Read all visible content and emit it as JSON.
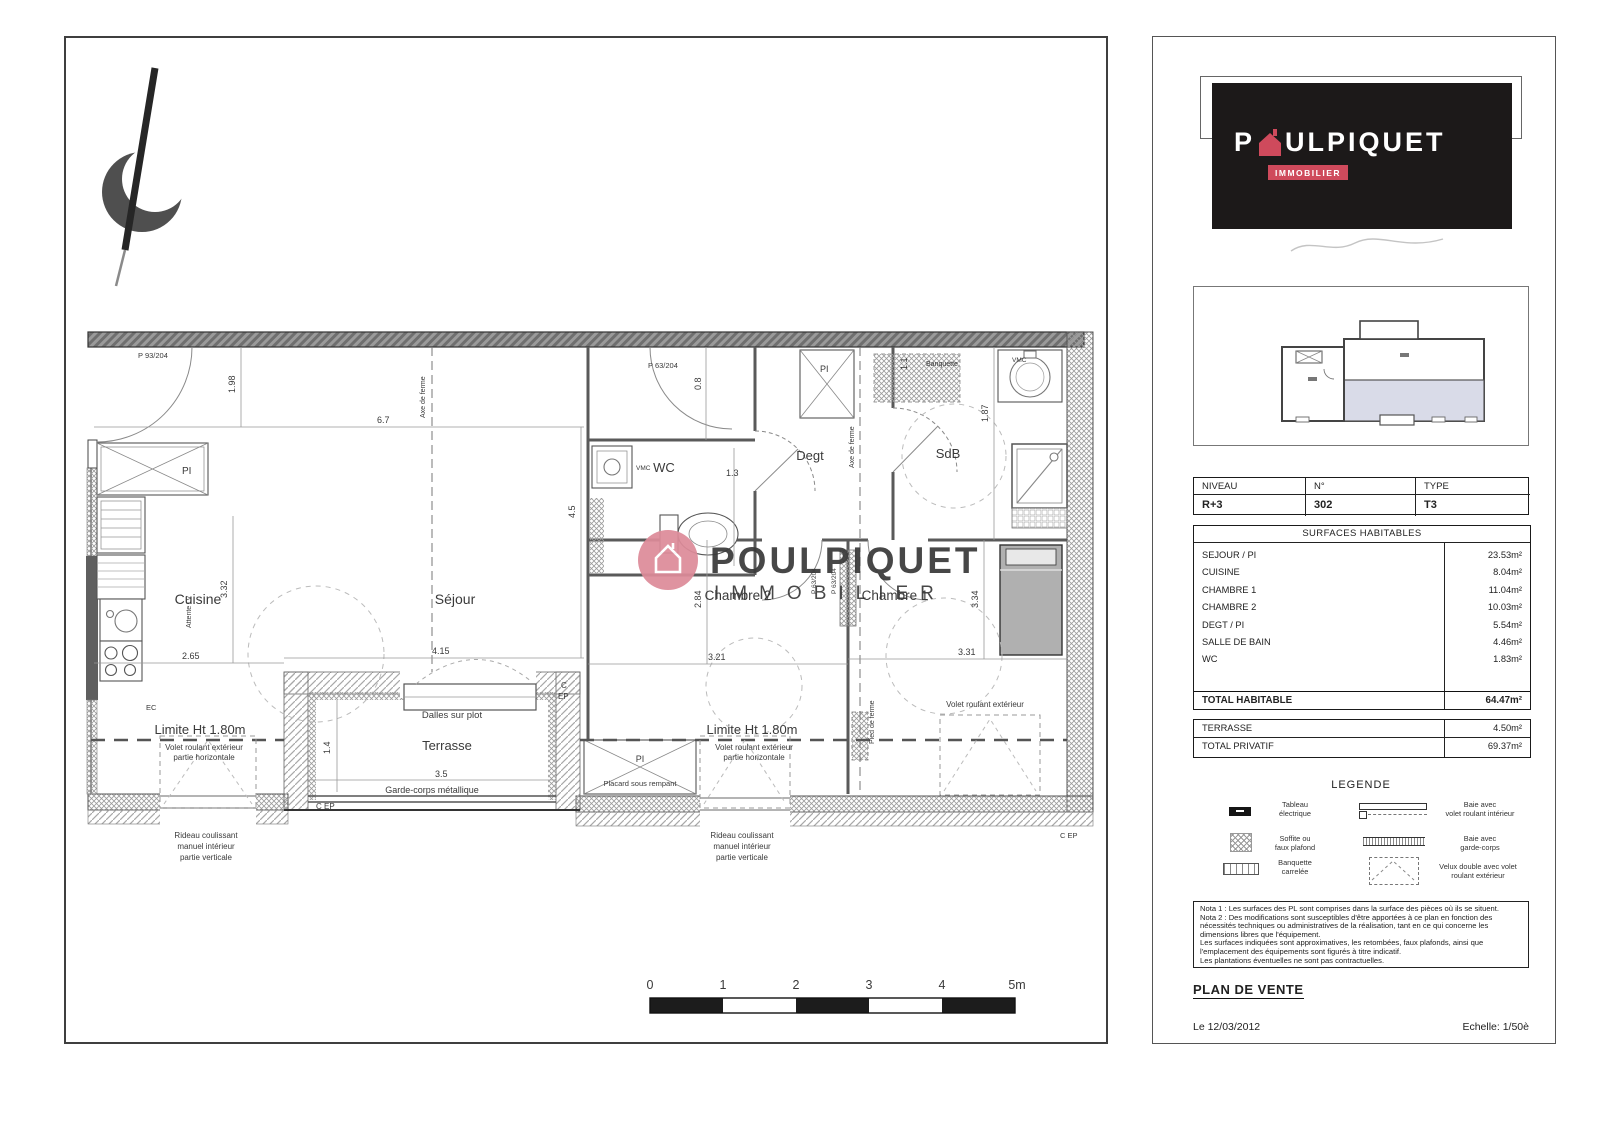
{
  "plan": {
    "rooms": {
      "cuisine": "Cuisine",
      "sejour": "Séjour",
      "wc": "WC",
      "degt": "Degt",
      "sdb": "SdB",
      "chambre2": "Chambre 2",
      "chambre1": "Chambre 1",
      "terrasse": "Terrasse"
    },
    "doors": {
      "entry": "P 93/204",
      "wc": "P 63/204",
      "ch2": "P 63/204",
      "ch1": "P 63/204"
    },
    "ann": {
      "limite": "Limite Ht 1.80m",
      "volet1": "Volet roulant extérieur",
      "volet2": "partie horizontale",
      "volet_ext": "Volet roulant extérieur",
      "rideau1": "Rideau coulissant",
      "rideau2": "manuel intérieur",
      "rideau3": "partie verticale",
      "dalles": "Dalles sur plot",
      "garde": "Garde-corps métallique",
      "placard": "Placard sous rempant",
      "pi": "PI",
      "ec": "EC",
      "vmc": "VMC",
      "banquette": "Banquette",
      "attente": "Attente LV",
      "axe": "Axe de ferme",
      "pied": "Pied de ferme",
      "c": "C",
      "ep": "EP",
      "cep": "C EP"
    },
    "dims": {
      "a": "1.98",
      "b": "6.7",
      "c": "4.5",
      "d": "0.8",
      "e": "1.3",
      "f": "1.1",
      "g": "1.87",
      "h": "3.32",
      "i": "2.65",
      "j": "4.15",
      "k": "2.84",
      "l": "3.21",
      "m": "3.34",
      "n": "3.31",
      "o": "1.4",
      "p": "3.5"
    },
    "scale_labels": [
      "0",
      "1",
      "2",
      "3",
      "4",
      "5m"
    ],
    "watermark": {
      "brand": "POULPIQUET",
      "sub": "IMMOBILIER"
    }
  },
  "sidebar": {
    "logo": {
      "p1": "P",
      "p2": "ULPIQUET",
      "sub": "IMMOBILIER"
    },
    "info": {
      "headers": [
        "NIVEAU",
        "N°",
        "TYPE"
      ],
      "values": [
        "R+3",
        "302",
        "T3"
      ]
    },
    "surfaces": {
      "title": "SURFACES HABITABLES",
      "rows": [
        {
          "label": "SEJOUR / PI",
          "value": "23.53m²"
        },
        {
          "label": "CUISINE",
          "value": "8.04m²"
        },
        {
          "label": "CHAMBRE 1",
          "value": "11.04m²"
        },
        {
          "label": "CHAMBRE 2",
          "value": "10.03m²"
        },
        {
          "label": "DEGT / PI",
          "value": "5.54m²"
        },
        {
          "label": "SALLE DE BAIN",
          "value": "4.46m²"
        },
        {
          "label": "WC",
          "value": "1.83m²"
        }
      ],
      "total_label": "TOTAL HABITABLE",
      "total_value": "64.47m²"
    },
    "privatif": {
      "rows": [
        {
          "label": "TERRASSE",
          "value": "4.50m²"
        },
        {
          "label": "TOTAL PRIVATIF",
          "value": "69.37m²"
        }
      ]
    },
    "legend": {
      "title": "LEGENDE",
      "items_left": [
        {
          "l1": "Tableau",
          "l2": "électrique"
        },
        {
          "l1": "Soffite ou",
          "l2": "faux plafond"
        },
        {
          "l1": "Banquette",
          "l2": "carrelée"
        }
      ],
      "items_right": [
        {
          "l1": "Baie avec",
          "l2": "volet roulant intérieur"
        },
        {
          "l1": "Baie avec",
          "l2": "garde-corps"
        },
        {
          "l1": "Velux double avec volet",
          "l2": "roulant extérieur"
        }
      ]
    },
    "notes": [
      "Nota 1 : Les surfaces des PL sont comprises dans la surface des pièces où ils se situent.",
      "Nota 2 : Des modifications sont susceptibles d'être apportées à ce plan en fonction des",
      "nécessités techniques ou administratives de la réalisation, tant en ce qui concerne les",
      "dimensions libres que l'équipement.",
      "Les surfaces indiquées sont approximatives, les retombées, faux plafonds, ainsi que",
      "l'emplacement des équipements sont figurés à titre indicatif.",
      "Les plantations éventuelles ne sont pas contractuelles."
    ],
    "footer": {
      "title": "PLAN DE VENTE",
      "date": "Le 12/03/2012",
      "scale": "Echelle: 1/50è"
    }
  }
}
